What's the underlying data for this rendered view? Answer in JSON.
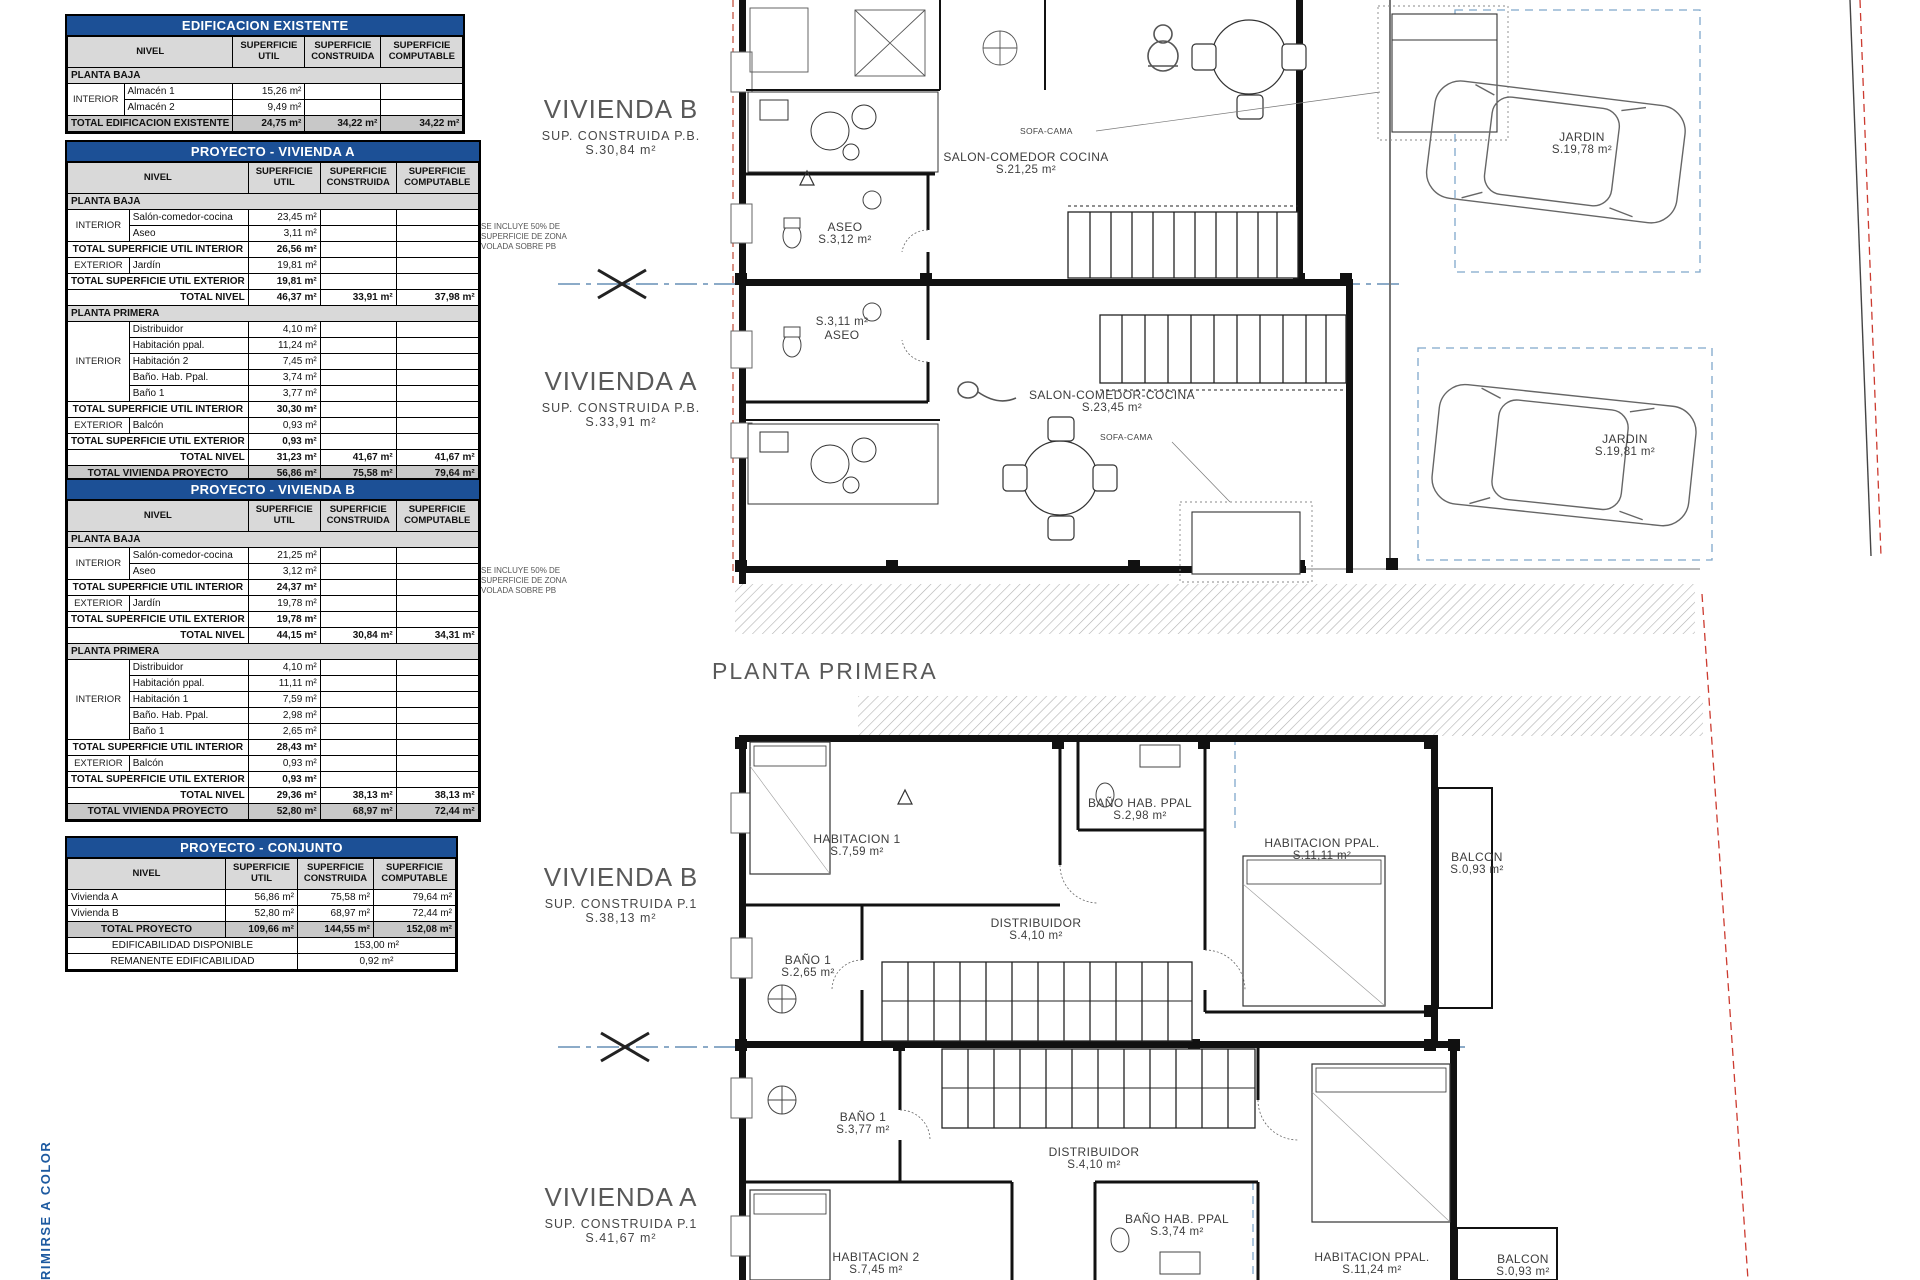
{
  "common": {
    "nivel": "NIVEL",
    "sup_util": "SUPERFICIE UTIL",
    "sup_constr": "SUPERFICIE CONSTRUIDA",
    "sup_comp": "SUPERFICIE COMPUTABLE",
    "planta_baja": "PLANTA BAJA",
    "planta_primera": "PLANTA PRIMERA",
    "interior": "INTERIOR",
    "exterior": "EXTERIOR",
    "tot_util_int": "TOTAL SUPERFICIE UTIL INTERIOR",
    "tot_util_ext": "TOTAL SUPERFICIE UTIL EXTERIOR",
    "tot_nivel": "TOTAL NIVEL",
    "tot_viv": "TOTAL VIVIENDA PROYECTO"
  },
  "colors": {
    "table_header_blue": "#1c5096",
    "section_line_blue": "#4879a8",
    "parcel_dashed_blue": "#7fa8cb",
    "boundary_red": "#c0504d"
  },
  "tables": {
    "existente": {
      "title": "EDIFICACION EXISTENTE",
      "r1_name": "Almacén 1",
      "r1_util": "15,26 m²",
      "r2_name": "Almacén 2",
      "r2_util": "9,49 m²",
      "total_label": "TOTAL EDIFICACION EXISTENTE",
      "total_util": "24,75 m²",
      "total_constr": "34,22 m²",
      "total_comp": "34,22 m²"
    },
    "viv_a": {
      "title": "PROYECTO - VIVIENDA A",
      "pb": {
        "salon": "Salón-comedor-cocina",
        "salon_util": "23,45 m²",
        "aseo": "Aseo",
        "aseo_util": "3,11 m²",
        "tot_int": "26,56 m²",
        "jardin": "Jardín",
        "jardin_util": "19,81 m²",
        "tot_ext": "19,81 m²",
        "nivel_util": "46,37 m²",
        "nivel_constr": "33,91 m²",
        "nivel_comp": "37,98 m²"
      },
      "p1": {
        "distribuidor": "Distribuidor",
        "distribuidor_util": "4,10 m²",
        "hab_ppal": "Habitación ppal.",
        "hab_ppal_util": "11,24 m²",
        "hab2": "Habitación 2",
        "hab2_util": "7,45 m²",
        "bano_ppal": "Baño. Hab. Ppal.",
        "bano_ppal_util": "3,74 m²",
        "bano1": "Baño 1",
        "bano1_util": "3,77 m²",
        "tot_int": "30,30 m²",
        "balcon": "Balcón",
        "balcon_util": "0,93 m²",
        "tot_ext": "0,93 m²",
        "nivel_util": "31,23 m²",
        "nivel_constr": "41,67 m²",
        "nivel_comp": "41,67 m²"
      },
      "total": {
        "util": "56,86 m²",
        "constr": "75,58 m²",
        "comp": "79,64 m²"
      }
    },
    "viv_b": {
      "title": "PROYECTO - VIVIENDA B",
      "pb": {
        "salon": "Salón-comedor-cocina",
        "salon_util": "21,25 m²",
        "aseo": "Aseo",
        "aseo_util": "3,12 m²",
        "tot_int": "24,37 m²",
        "jardin": "Jardín",
        "jardin_util": "19,78 m²",
        "tot_ext": "19,78 m²",
        "nivel_util": "44,15 m²",
        "nivel_constr": "30,84 m²",
        "nivel_comp": "34,31 m²"
      },
      "p1": {
        "distribuidor": "Distribuidor",
        "distribuidor_util": "4,10 m²",
        "hab_ppal": "Habitación ppal.",
        "hab_ppal_util": "11,11 m²",
        "hab1": "Habitación 1",
        "hab1_util": "7,59 m²",
        "bano_ppal": "Baño. Hab. Ppal.",
        "bano_ppal_util": "2,98 m²",
        "bano1": "Baño 1",
        "bano1_util": "2,65 m²",
        "tot_int": "28,43 m²",
        "balcon": "Balcón",
        "balcon_util": "0,93 m²",
        "tot_ext": "0,93 m²",
        "nivel_util": "29,36 m²",
        "nivel_constr": "38,13 m²",
        "nivel_comp": "38,13 m²"
      },
      "total": {
        "util": "52,80 m²",
        "constr": "68,97 m²",
        "comp": "72,44 m²"
      }
    },
    "conjunto": {
      "title": "PROYECTO - CONJUNTO",
      "viv_a": "Vivienda A",
      "a_util": "56,86 m²",
      "a_constr": "75,58 m²",
      "a_comp": "79,64 m²",
      "viv_b": "Vivienda B",
      "b_util": "52,80 m²",
      "b_constr": "68,97 m²",
      "b_comp": "72,44 m²",
      "total_label": "TOTAL PROYECTO",
      "t_util": "109,66 m²",
      "t_constr": "144,55 m²",
      "t_comp": "152,08 m²",
      "edif_label": "EDIFICABILIDAD DISPONIBLE",
      "edif_value": "153,00 m²",
      "rem_label": "REMANENTE EDIFICABILIDAD",
      "rem_value": "0,92 m²"
    }
  },
  "plan": {
    "note_50": "SE INCLUYE 50% DE SUPERFICIE DE ZONA VOLADA SOBRE PB",
    "floor_title": "PLANTA PRIMERA",
    "print_note": "RIMIRSE A COLOR",
    "pb": {
      "viv_b_title": "VIVIENDA B",
      "viv_b_sub": "SUP. CONSTRUIDA P.B.",
      "viv_b_area": "S.30,84 m²",
      "viv_a_title": "VIVIENDA A",
      "viv_a_sub": "SUP. CONSTRUIDA P.B.",
      "viv_a_area": "S.33,91 m²",
      "salon_b": "SALON-COMEDOR COCINA",
      "salon_b_area": "S.21,25 m²",
      "aseo_b": "ASEO",
      "aseo_b_area": "S.3,12 m²",
      "aseo_a": "ASEO",
      "aseo_a_area": "S.3,11 m²",
      "salon_a": "SALON-COMEDOR-COCINA",
      "salon_a_area": "S.23,45 m²",
      "jardin_b": "JARDIN",
      "jardin_b_area": "S.19,78 m²",
      "jardin_a": "JARDIN",
      "jardin_a_area": "S.19,81 m²",
      "sofa_b": "SOFA-CAMA",
      "sofa_a": "SOFA-CAMA"
    },
    "p1": {
      "viv_b_title": "VIVIENDA B",
      "viv_b_sub": "SUP. CONSTRUIDA P.1",
      "viv_b_area": "S.38,13 m²",
      "viv_a_title": "VIVIENDA A",
      "viv_a_sub": "SUP. CONSTRUIDA P.1",
      "viv_a_area": "S.41,67 m²",
      "hab1_b": "HABITACION 1",
      "hab1_b_area": "S.7,59 m²",
      "banop_b": "BAÑO HAB. PPAL",
      "banop_b_area": "S.2,98 m²",
      "habp_b": "HABITACION PPAL.",
      "habp_b_area": "S.11,11 m²",
      "balcon_b": "BALCON",
      "balcon_b_area": "S.0,93 m²",
      "dist_b": "DISTRIBUIDOR",
      "dist_b_area": "S.4,10 m²",
      "bano1_b": "BAÑO 1",
      "bano1_b_area": "S.2,65 m²",
      "bano1_a": "BAÑO 1",
      "bano1_a_area": "S.3,77 m²",
      "dist_a": "DISTRIBUIDOR",
      "dist_a_area": "S.4,10 m²",
      "hab2_a": "HABITACION 2",
      "hab2_a_area": "S.7,45 m²",
      "banop_a": "BAÑO HAB. PPAL",
      "banop_a_area": "S.3,74 m²",
      "habp_a": "HABITACION PPAL.",
      "habp_a_area": "S.11,24 m²",
      "balcon_a": "BALCON",
      "balcon_a_area": "S.0,93 m²"
    }
  }
}
